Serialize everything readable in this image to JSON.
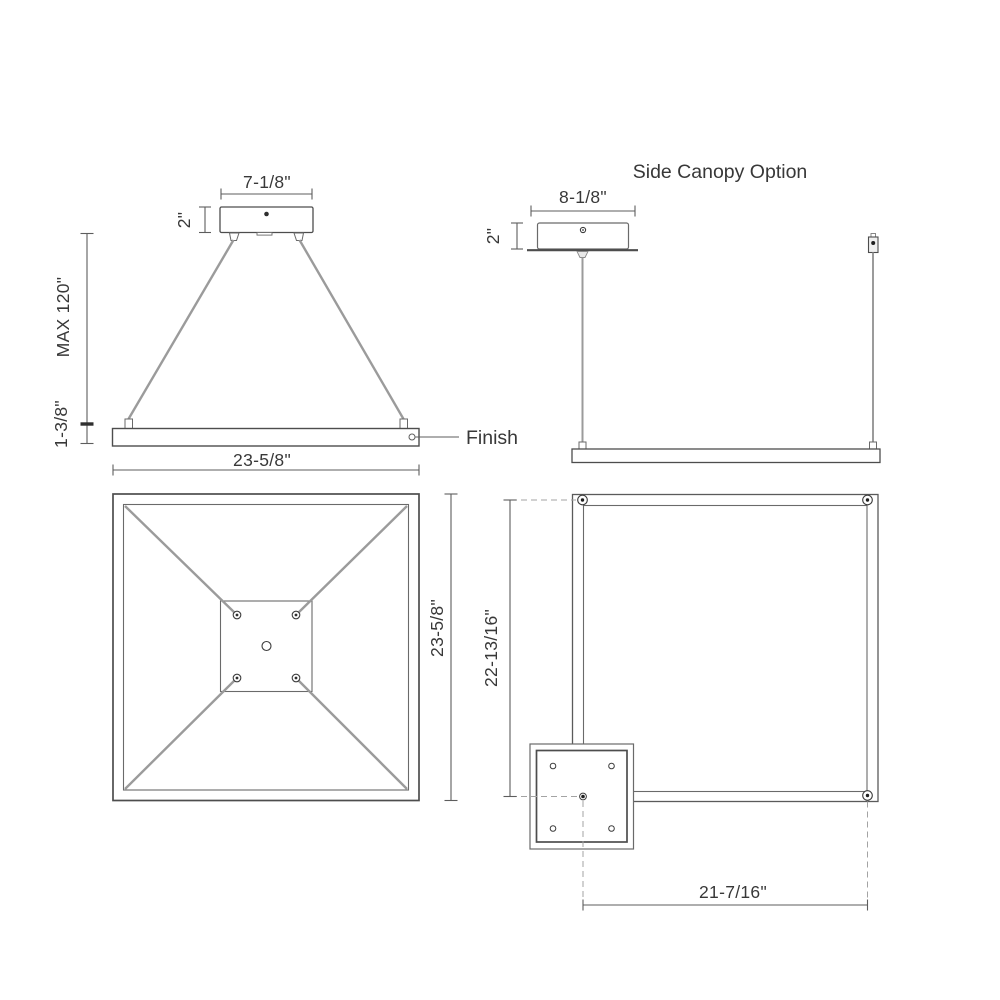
{
  "drawing": {
    "front_view": {
      "canopy_width": "7-1/8\"",
      "canopy_height": "2\"",
      "max_drop": "MAX 120\"",
      "bar_height": "1-3/8\"",
      "bar_width": "23-5/8\"",
      "finish_label": "Finish"
    },
    "side_view": {
      "title": "Side Canopy Option",
      "canopy_width": "8-1/8\"",
      "canopy_height": "2\""
    },
    "plan_center_view": {
      "fixture_depth": "23-5/8\""
    },
    "plan_side_view": {
      "canopy_offset_vertical": "22-13/16\"",
      "canopy_offset_horizontal": "21-7/16\""
    },
    "colors": {
      "outline": "#4d4d4d",
      "dimension_line": "#5d5d5d",
      "cable": "#9b9b9b",
      "dashed_line": "#a3a3a3",
      "text": "#383838",
      "background": "#ffffff"
    }
  }
}
